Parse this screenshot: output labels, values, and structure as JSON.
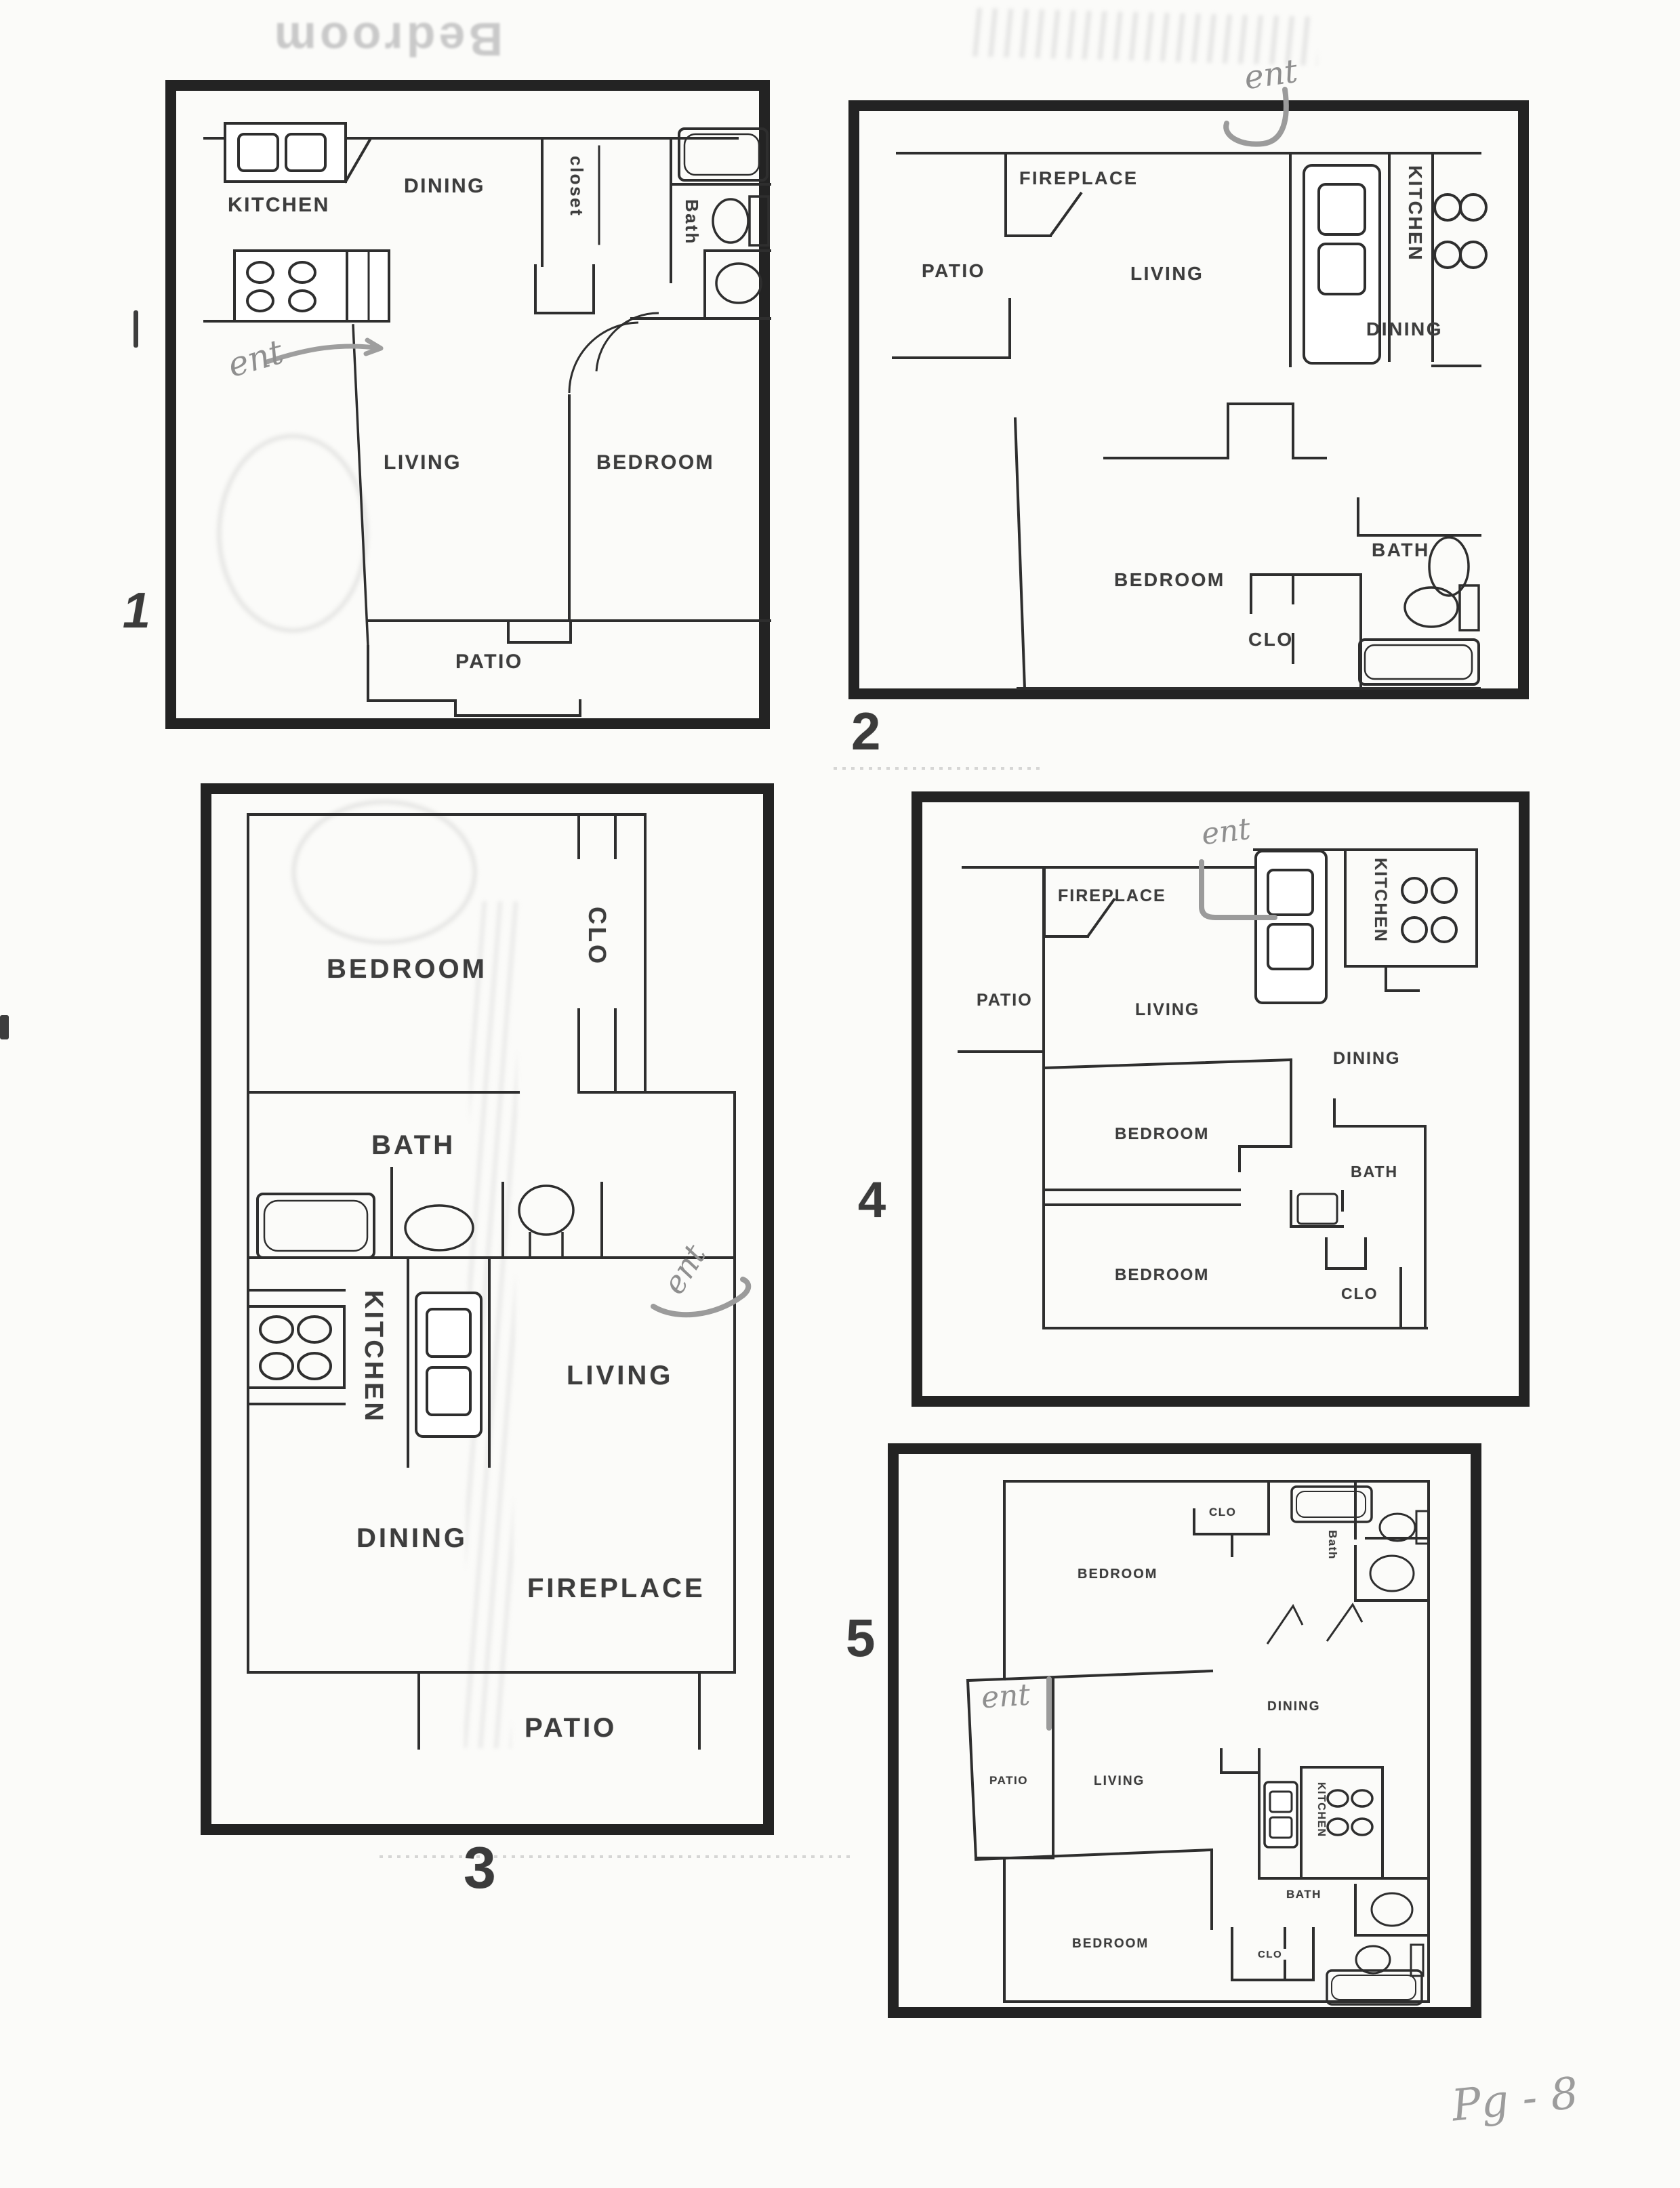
{
  "document": {
    "type": "scanned floor-plan sheet",
    "page_number_handwritten": "Pg - 8",
    "colors": {
      "paper": "#fbfbf9",
      "ink": "#2e2e2e",
      "border": "#232323",
      "pencil_annotation": "#8f8f8f",
      "label_text": "#3d3d3d"
    },
    "icons": [
      "bathtub-icon",
      "toilet-icon",
      "sink-oval-icon",
      "double-sink-icon",
      "stove-burners-icon",
      "door-swing-icon",
      "fireplace-icon",
      "closet-rail-icon"
    ],
    "bleed_through": {
      "top_left_text": "Bedroom"
    },
    "plans": [
      {
        "number": "1",
        "annotation": "ent",
        "labels": [
          {
            "text": "KITCHEN"
          },
          {
            "text": "DINING"
          },
          {
            "text": "closet"
          },
          {
            "text": "Bath"
          },
          {
            "text": "LIVING"
          },
          {
            "text": "BEDROOM"
          },
          {
            "text": "PATIO"
          }
        ]
      },
      {
        "number": "2",
        "annotation": "ent",
        "labels": [
          {
            "text": "FIREPLACE"
          },
          {
            "text": "PATIO"
          },
          {
            "text": "LIVING"
          },
          {
            "text": "KITCHEN"
          },
          {
            "text": "DINING"
          },
          {
            "text": "BEDROOM"
          },
          {
            "text": "BATH"
          },
          {
            "text": "CLO"
          }
        ]
      },
      {
        "number": "3",
        "annotation": "ent",
        "labels": [
          {
            "text": "BEDROOM"
          },
          {
            "text": "CLO"
          },
          {
            "text": "BATH"
          },
          {
            "text": "KITCHEN"
          },
          {
            "text": "LIVING"
          },
          {
            "text": "DINING"
          },
          {
            "text": "FIREPLACE"
          },
          {
            "text": "PATIO"
          }
        ]
      },
      {
        "number": "4",
        "annotation": "ent",
        "labels": [
          {
            "text": "FIREPLACE"
          },
          {
            "text": "PATIO"
          },
          {
            "text": "LIVING"
          },
          {
            "text": "KITCHEN"
          },
          {
            "text": "DINING"
          },
          {
            "text": "BEDROOM"
          },
          {
            "text": "BATH"
          },
          {
            "text": "BEDROOM"
          },
          {
            "text": "CLO"
          }
        ]
      },
      {
        "number": "5",
        "annotation": "ent",
        "labels": [
          {
            "text": "BEDROOM"
          },
          {
            "text": "CLO"
          },
          {
            "text": "Bath"
          },
          {
            "text": "DINING"
          },
          {
            "text": "PATIO"
          },
          {
            "text": "LIVING"
          },
          {
            "text": "KITCHEN"
          },
          {
            "text": "BATH"
          },
          {
            "text": "CLO"
          },
          {
            "text": "BEDROOM"
          }
        ]
      }
    ]
  }
}
